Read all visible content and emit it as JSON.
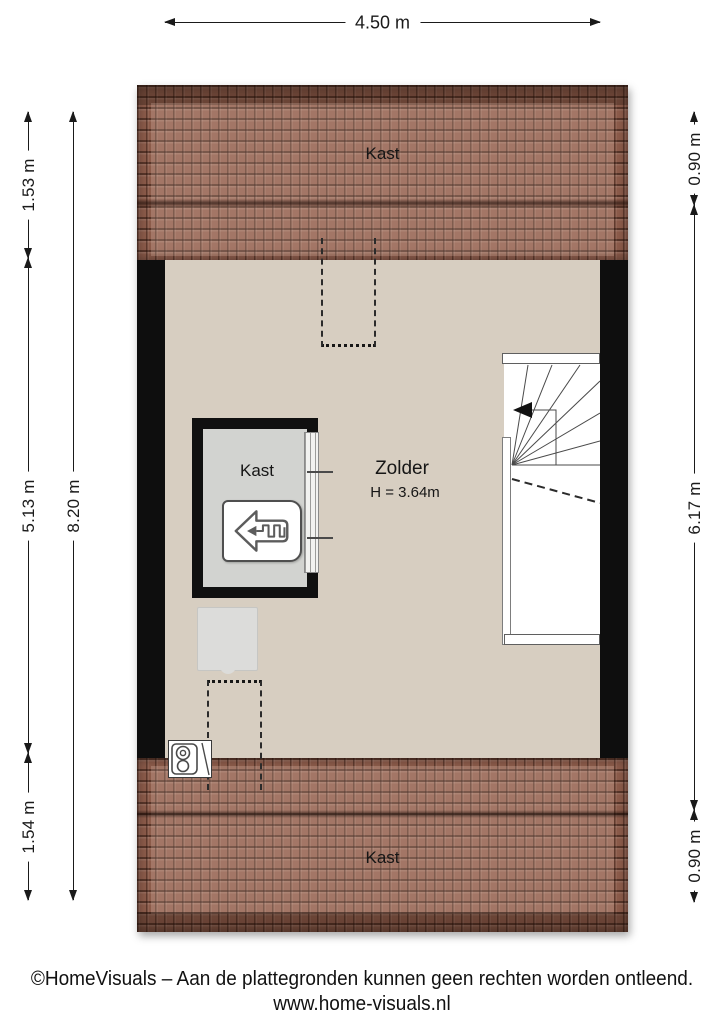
{
  "dimensions": {
    "top": "4.50 m",
    "left_segments": [
      "1.53 m",
      "5.13 m",
      "1.54 m"
    ],
    "left_total": "8.20 m",
    "right_segments": [
      "0.90 m",
      "6.17 m",
      "0.90 m"
    ]
  },
  "rooms": {
    "attic_name": "Zolder",
    "attic_height": "H = 3.64m",
    "closet_label": "Kast",
    "roof_top_label": "Kast",
    "roof_bottom_label": "Kast"
  },
  "colors": {
    "roof_tile": "#8d5c4b",
    "floor": "#d7cec1",
    "wall": "#0e0e0e",
    "closet_floor": "#d2d3d0",
    "background": "#ffffff"
  },
  "footer": {
    "line1": "©HomeVisuals – Aan de plattegronden kunnen geen rechten worden ontleend.",
    "line2": "www.home-visuals.nl"
  }
}
